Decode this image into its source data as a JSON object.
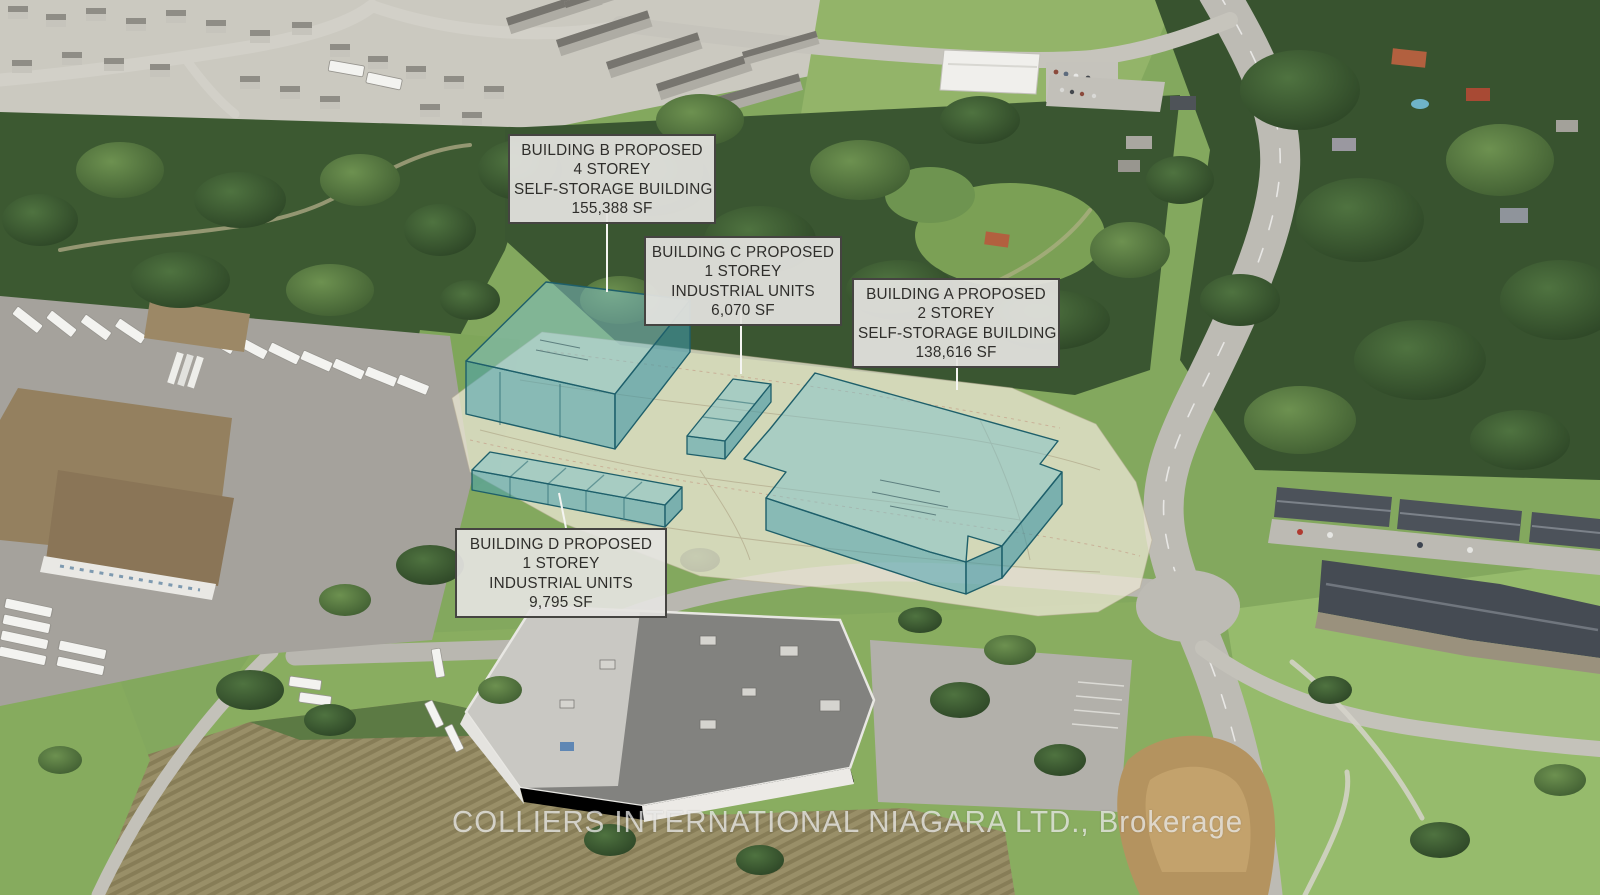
{
  "scene": {
    "description": "Aerial rendering of a proposed industrial / self-storage development site with four highlighted proposed buildings overlaid on satellite photography"
  },
  "labels": {
    "building_b": {
      "lines": [
        "BUILDING B PROPOSED",
        "4 STOREY",
        "SELF-STORAGE BUILDING",
        "155,388 SF"
      ]
    },
    "building_c": {
      "lines": [
        "BUILDING C PROPOSED",
        "1 STOREY",
        "INDUSTRIAL UNITS",
        "6,070 SF"
      ]
    },
    "building_a": {
      "lines": [
        "BUILDING A PROPOSED",
        "2 STOREY",
        "SELF-STORAGE BUILDING",
        "138,616 SF"
      ]
    },
    "building_d": {
      "lines": [
        "BUILDING D PROPOSED",
        "1 STOREY",
        "INDUSTRIAL UNITS",
        "9,795 SF"
      ]
    }
  },
  "watermark": {
    "text": "COLLIERS INTERNATIONAL NIAGARA LTD., Brokerage"
  },
  "colors": {
    "proposed_fill_top": "#7fc2cb",
    "proposed_fill_wall": "#4aa3b2",
    "proposed_outline": "#1e5f6a",
    "site_overlay": "#e9e5d2",
    "label_background": "#e4e3e0",
    "label_border": "#454441",
    "label_text": "#2f2e2b",
    "watermark_text": "#f2f2f0"
  }
}
